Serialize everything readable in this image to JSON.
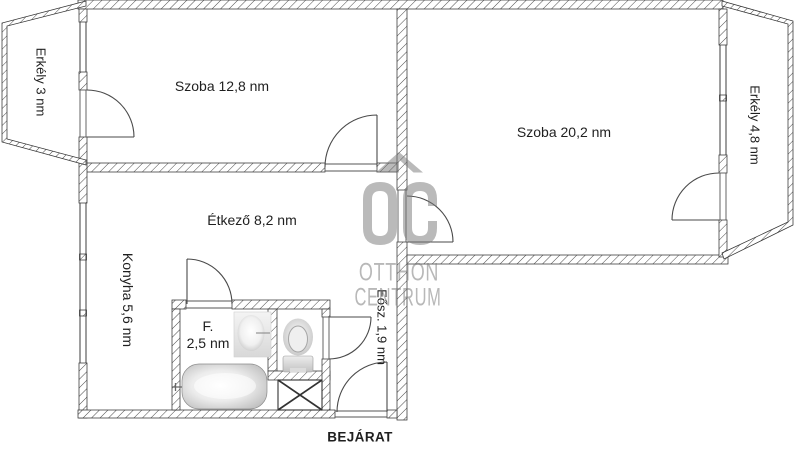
{
  "floorplan": {
    "rooms": {
      "szoba_small": "Szoba 12,8 nm",
      "szoba_large": "Szoba 20,2 nm",
      "etkezo": "Étkező 8,2 nm",
      "konyha": "Konyha 5,6 nm",
      "bathroom_abbr": "F.",
      "bathroom_area": "2,5 nm",
      "eosz": "Eősz. 1,9 nm",
      "balcony_left": "Erkély 3 nm",
      "balcony_right": "Erkély 4,8 nm"
    },
    "entrance_label": "BEJÁRAT",
    "watermark": {
      "initials": "OC",
      "line1": "OTTHON",
      "line2": "CENTRUM"
    },
    "colors": {
      "background": "#ffffff",
      "wall_line": "#333333",
      "hatch": "#4a4a4a",
      "door_line": "#4a4a4a",
      "text": "#1f1f1f",
      "watermark_gray": "#bdbdbd",
      "fixture_gray": "#c0c0c0"
    }
  }
}
